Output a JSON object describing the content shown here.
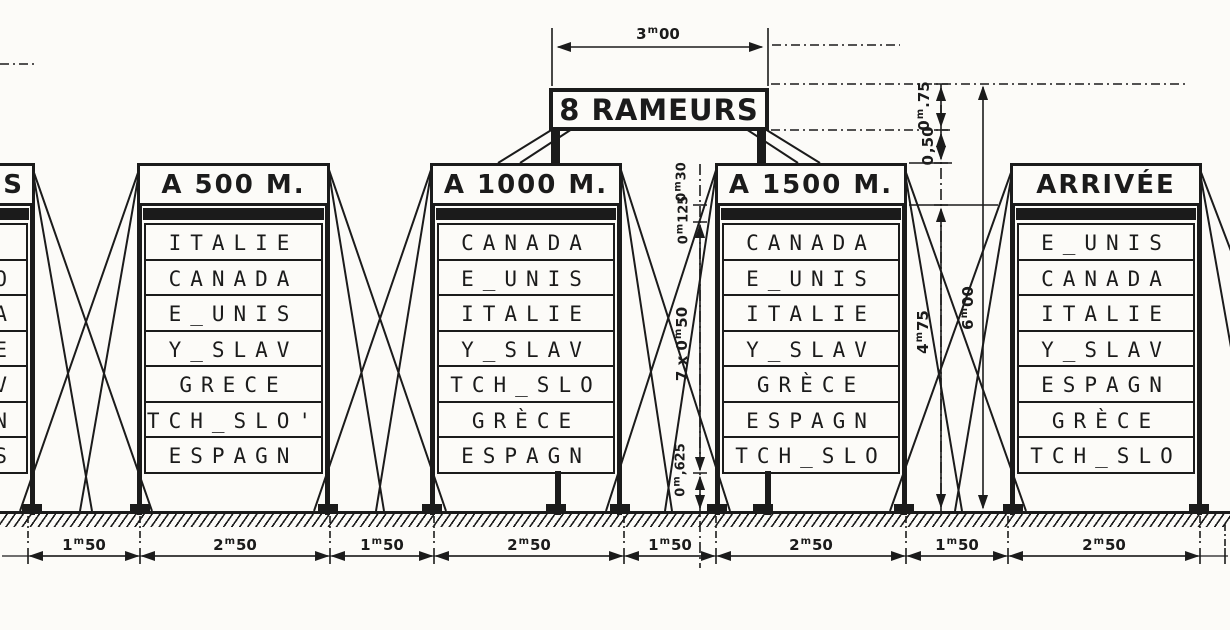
{
  "sign": {
    "label": "8 RAMEURS"
  },
  "boards": [
    {
      "id": "left-partial",
      "header": "S",
      "rows": [
        "",
        "O",
        "A",
        "E",
        "V",
        "N",
        "S"
      ]
    },
    {
      "id": "a-500-m",
      "header": "A 500 M.",
      "rows": [
        "ITALIE",
        "CANADA",
        "E_UNIS",
        "Y_SLAV",
        "GRECE",
        "TCH_SLO'",
        "ESPAGN"
      ]
    },
    {
      "id": "a-1000-m",
      "header": "A 1000 M.",
      "rows": [
        "CANADA",
        "E_UNIS",
        "ITALIE",
        "Y_SLAV",
        "TCH_SLO",
        "GRÈCE",
        "ESPAGN"
      ]
    },
    {
      "id": "a-1500-m",
      "header": "A 1500 M.",
      "rows": [
        "CANADA",
        "E_UNIS",
        "ITALIE",
        "Y_SLAV",
        "GRÈCE",
        "ESPAGN",
        "TCH_SLO"
      ]
    },
    {
      "id": "arrivee",
      "header": "ARRIVÉE",
      "rows": [
        "E_UNIS",
        "CANADA",
        "ITALIE",
        "Y_SLAV",
        "ESPAGN",
        "GRÈCE",
        "TCH_SLO"
      ]
    }
  ],
  "dimensions": {
    "sign_width": {
      "pre": "3",
      "sup": "m",
      "post": "00"
    },
    "sign_band_height": {
      "pre": "0",
      "sup": "m",
      "post": ".75"
    },
    "sign_to_boards": {
      "pre": "0",
      "sup": "",
      "post": ",50"
    },
    "header_height": {
      "pre": "0",
      "sup": "m",
      "post": "30"
    },
    "rail_height": {
      "pre": "0",
      "sup": "m",
      "post": "125"
    },
    "rows_height": {
      "pre": "7 x 0",
      "sup": "m",
      "post": "50"
    },
    "legs_height": {
      "pre": "0",
      "sup": "m",
      "post": ",625"
    },
    "board_height": {
      "pre": "4",
      "sup": "m",
      "post": "75"
    },
    "overall_height": {
      "pre": "6",
      "sup": "m",
      "post": "00"
    },
    "chain": [
      {
        "pre": "1",
        "sup": "m",
        "post": "50"
      },
      {
        "pre": "2",
        "sup": "m",
        "post": "50"
      },
      {
        "pre": "1",
        "sup": "m",
        "post": "50"
      },
      {
        "pre": "2",
        "sup": "m",
        "post": "50"
      },
      {
        "pre": "1",
        "sup": "m",
        "post": "50"
      },
      {
        "pre": "2",
        "sup": "m",
        "post": "50"
      },
      {
        "pre": "1",
        "sup": "m",
        "post": "50"
      },
      {
        "pre": "2",
        "sup": "m",
        "post": "50"
      }
    ]
  }
}
